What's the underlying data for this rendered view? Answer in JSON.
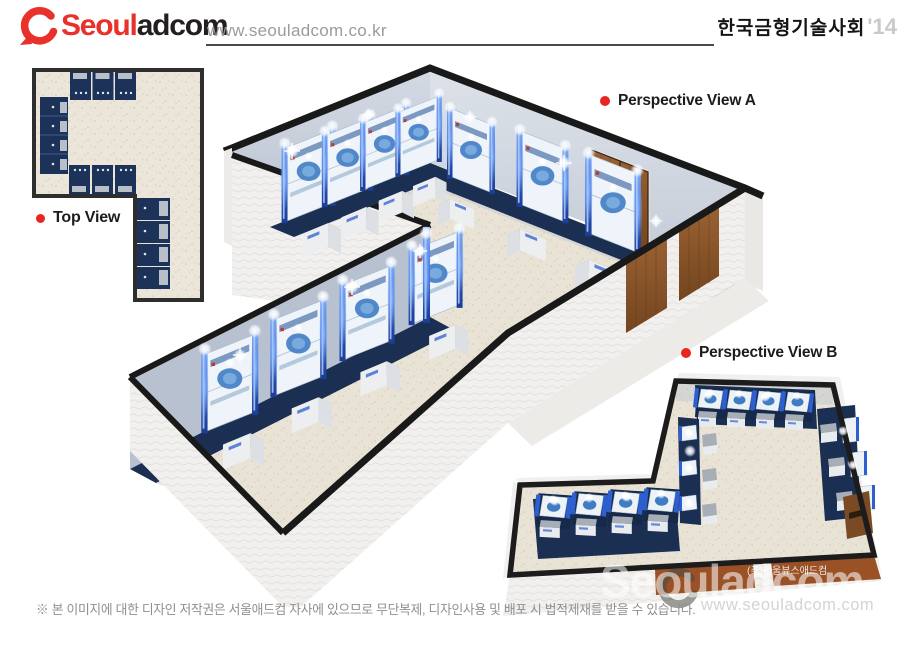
{
  "header": {
    "logo": {
      "brand_red": "Seoul",
      "brand_dark": "adcom",
      "icon": "red-swoosh-ring"
    },
    "website": "www.seouladcom.co.kr",
    "event_title": "한국금형기술사회",
    "event_year": "'14"
  },
  "views": {
    "top_view": {
      "label": "Top View"
    },
    "perspective_a": {
      "label": "Perspective View A"
    },
    "perspective_b": {
      "label": "Perspective View B"
    }
  },
  "scene": {
    "description": "L-shaped exhibition hall 3D renders",
    "booth_rows": {
      "top_view": {
        "top_wall": 3,
        "left_wall": 4,
        "middle_wall": 3,
        "right_wall": 4
      },
      "perspective_a": {
        "left_wall": 4,
        "far_wall": 3,
        "wing_wall": 4,
        "interior_doors": 1,
        "exterior_doors": 2
      },
      "perspective_b": {
        "top_wall": 4,
        "wing_wall": 4,
        "center_column": 3,
        "right_wall": 3,
        "doors": 1
      }
    }
  },
  "footer": {
    "copyright": "※ 본 이미지에 대한 디자인 저작권은 서울애드컴 자사에 있으므로 무단복제, 디자인사용 및 배포 시 법적제재를 받을 수 있습니다."
  },
  "watermark": {
    "brand": "Seouladcom",
    "url": "www.seouladcom.com",
    "company": "(주)서울뷰스애드컴"
  },
  "colors": {
    "accent_red": "#e8312a",
    "logo_dark": "#231f20",
    "booth_navy": "#1b2f52",
    "pillar_blue": "#2d5fd0",
    "wood_brown": "#8a5329",
    "floor_beige": "#eae4d8",
    "wall_white": "#f0efee",
    "trim_black": "#1b1b1b",
    "url_gray": "#9b9b9b",
    "year_gray": "#c9c9c9"
  }
}
